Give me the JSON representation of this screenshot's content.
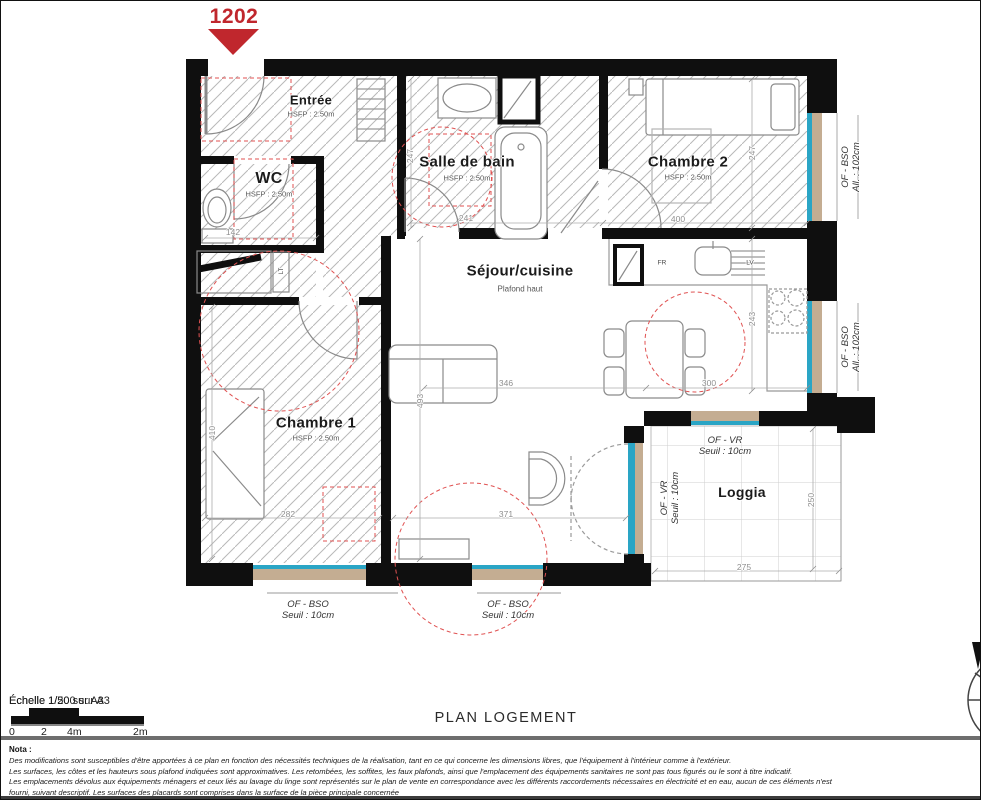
{
  "unit": {
    "number": "1202"
  },
  "plan": {
    "rooms": {
      "entree": {
        "name": "Entrée",
        "hsfp": "HSFP : 2.50m"
      },
      "wc": {
        "name": "WC",
        "hsfp": "HSFP : 2.50m"
      },
      "salle_de_bain": {
        "name": "Salle de bain",
        "hsfp": "HSFP : 2.50m"
      },
      "chambre2": {
        "name": "Chambre 2",
        "hsfp": "HSFP : 2.50m"
      },
      "sejour": {
        "name": "Séjour/cuisine",
        "note": "Plafond haut"
      },
      "chambre1": {
        "name": "Chambre 1",
        "hsfp": "HSFP : 2.50m"
      },
      "loggia": {
        "name": "Loggia"
      }
    },
    "appliances": {
      "fridge": "FR",
      "dishwasher": "LV",
      "laundry": "LT"
    },
    "dimensions_cm": {
      "wc_width": "142",
      "sdb_width": "241",
      "sdb_depth": "247",
      "ch2_width": "400",
      "ch2_depth": "247",
      "sejour_width": "346",
      "sejour_depth": "493",
      "kitchen_width": "300",
      "kitchen_depth": "243",
      "ch1_depth": "410",
      "ch1_width": "282",
      "sejour_south": "371",
      "loggia_width": "275",
      "loggia_depth": "250"
    },
    "windows": {
      "ch2_east": {
        "type": "OF - BSO",
        "detail": "All. : 102cm"
      },
      "sejour_east": {
        "type": "OF - BSO",
        "detail": "All. : 102cm"
      },
      "ch1_south": {
        "type": "OF - BSO",
        "detail": "Seuil : 10cm"
      },
      "sejour_south": {
        "type": "OF - BSO",
        "detail": "Seuil : 10cm"
      },
      "loggia_north": {
        "type": "OF - VR",
        "detail": "Seuil : 10cm"
      },
      "loggia_west": {
        "type": "OF - VR",
        "detail": "Seuil : 10cm"
      }
    },
    "colors": {
      "accent_red": "#c0272d",
      "glass_cyan": "#2aa5c5",
      "sill_tan": "#c4ad92"
    }
  },
  "footer": {
    "scale_a": "Échelle 1/50 sur A3",
    "scale_b": "Échelle 1/200 sur A3",
    "ticks": [
      "0",
      "2",
      "4m",
      "2m"
    ],
    "title": "PLAN LOGEMENT",
    "nota_heading": "Nota :",
    "nota_lines": [
      "Des modifications sont susceptibles d'être apportées à ce plan en fonction des nécessités techniques de la réalisation, tant en ce qui concerne les dimensions libres, que l'équipement à l'intérieur comme à l'extérieur.",
      "Les surfaces, les côtes et les hauteurs sous plafond indiquées sont approximatives. Les retombées, les soffites, les faux plafonds, ainsi que l'emplacement des équipements sanitaires ne sont pas tous figurés ou le sont à titre indicatif.",
      "Les emplacements dévolus aux équipements ménagers et ceux liés au lavage du linge sont représentés sur le plan de vente en correspondance avec les différents raccordements nécessaires en électricité et en eau, aucun de ces éléments n'est",
      "fourni, suivant descriptif. Les surfaces des placards sont comprises dans la surface de la pièce principale concernée"
    ]
  }
}
